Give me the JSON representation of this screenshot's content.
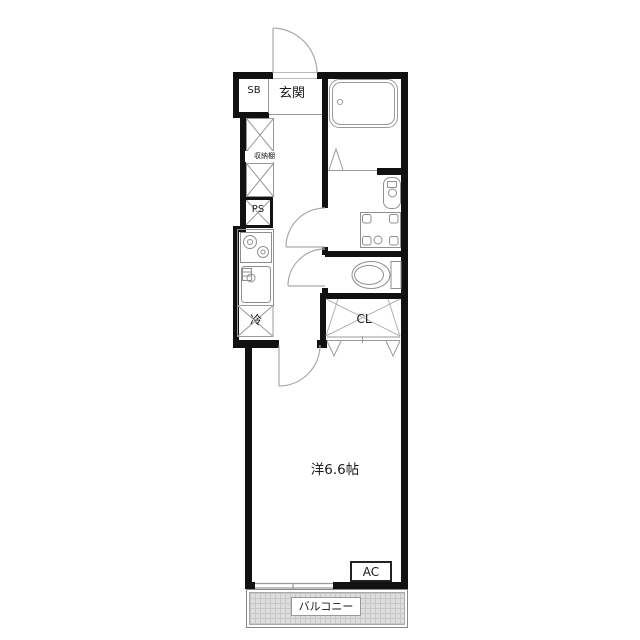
{
  "floorplan": {
    "labels": {
      "shoe_box": "SB",
      "entrance": "玄関",
      "storage_shelf": "収納棚",
      "pipe_space": "PS",
      "refrigerator": "冷",
      "closet": "CL",
      "western_room": "洋6.6帖",
      "air_conditioner": "AC",
      "balcony": "バルコニー"
    },
    "colors": {
      "wall": "#111111",
      "fixture_line": "#999999",
      "door_arc_line": "#aaaaaa",
      "balcony_fill": "#dedede",
      "background": "#ffffff"
    }
  }
}
